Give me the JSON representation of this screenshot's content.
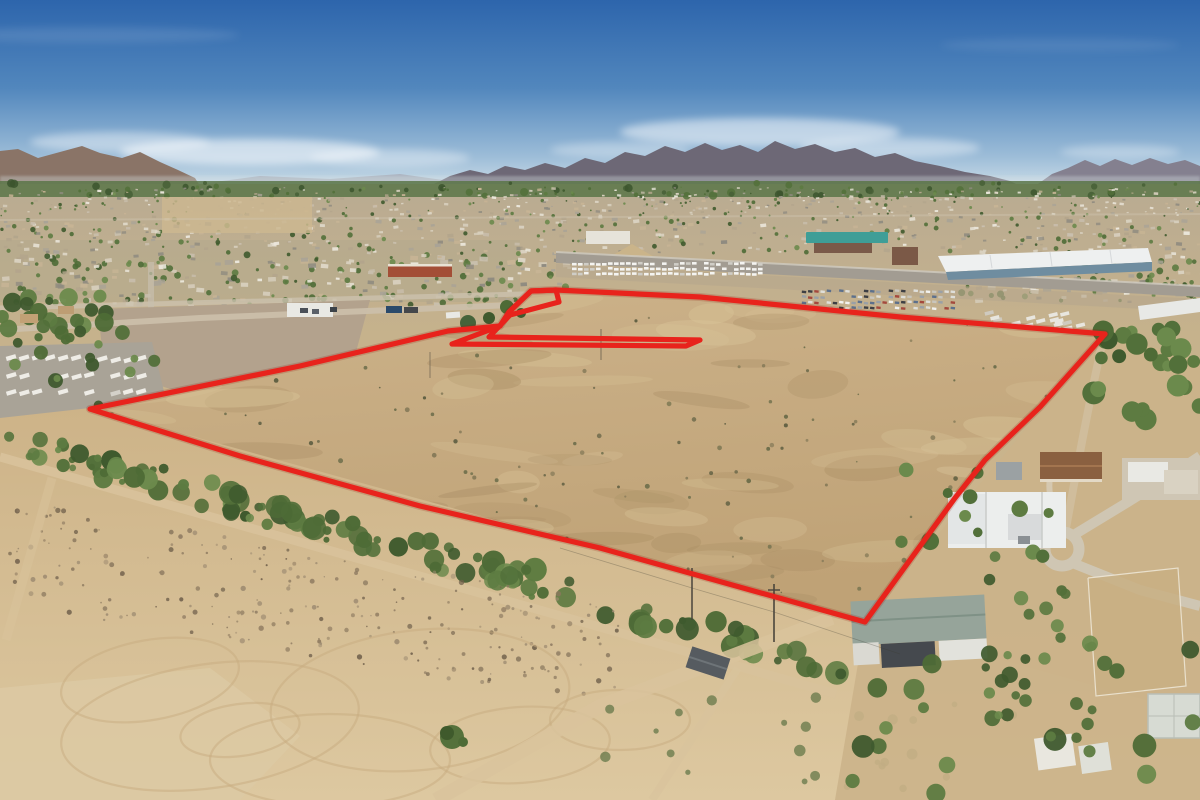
{
  "image": {
    "type": "aerial-drone-photograph",
    "subject": "vacant desert land parcel outlined in red, city and mountains on horizon",
    "width_px": 1200,
    "height_px": 800
  },
  "palette": {
    "sky_top": "#2d65ac",
    "sky_mid": "#6f9cc9",
    "sky_horizon": "#d9e6ec",
    "cloud": "#ffffff",
    "mountain_far": "#a6abb6",
    "mountain_left": "#8a7467",
    "mountain_center": "#6d6876",
    "mountain_right": "#84808f",
    "greenbelt": "#5b7648",
    "city_ground": "#bfb097",
    "highway": "#a29c92",
    "warehouse_roof": "#eef0f0",
    "warehouse_face": "#6f8da0",
    "roof_red": "#a34e36",
    "roof_teal": "#3f9e97",
    "parcel_dirt_light": "#ccb28a",
    "parcel_dirt_dark": "#bfa276",
    "foreground_sand": "#d8c096",
    "vegetation": "#52703a",
    "road_dirt": "#d8c29b",
    "house_white": "#eceeed",
    "roof_sage": "#96a49a",
    "roof_brown": "#8a6040",
    "red_outline": "#e8231c"
  },
  "annotation": {
    "parcel_outline": {
      "color": "#e8231c",
      "stroke_width": 5.2,
      "closed": true,
      "points": [
        [
          90,
          409
        ],
        [
          300,
          366
        ],
        [
          448,
          331
        ],
        [
          500,
          326
        ],
        [
          509,
          312
        ],
        [
          531,
          291
        ],
        [
          556,
          290
        ],
        [
          700,
          297
        ],
        [
          900,
          317
        ],
        [
          1105,
          334
        ],
        [
          1040,
          407
        ],
        [
          985,
          460
        ],
        [
          955,
          498
        ],
        [
          865,
          622
        ],
        [
          600,
          548
        ],
        [
          420,
          506
        ],
        [
          240,
          456
        ]
      ]
    },
    "excluded_cutout": {
      "color": "#e8231c",
      "stroke_width": 5.2,
      "closed": true,
      "points": [
        [
          556,
          290
        ],
        [
          559,
          302
        ],
        [
          510,
          315
        ],
        [
          489,
          337
        ],
        [
          700,
          340
        ],
        [
          686,
          346
        ],
        [
          452,
          344
        ],
        [
          500,
          326
        ],
        [
          509,
          312
        ],
        [
          531,
          291
        ]
      ]
    }
  },
  "scene": {
    "sky": {
      "has_clouds": true,
      "cloud_band_y": 145
    },
    "landmarks": [
      "jagged mountain range on horizon",
      "city sprawl with trees and buildings",
      "white industrial warehouse",
      "highway with traffic",
      "rv and trailer parking lot",
      "graded gray dirt pad",
      "red boundary around vacant parcel",
      "diagonal band of green trees",
      "residential homes with cul-de-sac",
      "white mansion",
      "house under construction with sage roof",
      "sandy desert foreground with tire tracks"
    ]
  }
}
